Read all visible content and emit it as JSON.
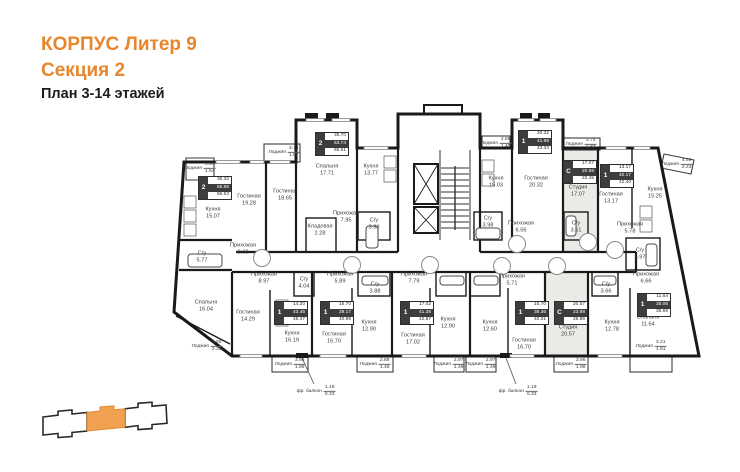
{
  "header": {
    "line1": "КОРПУС Литер 9",
    "line2": "Секция 2",
    "line3": "План 3-14 этажей"
  },
  "colors": {
    "accent": "#E8862B",
    "wall": "#1A1A1A",
    "stamp_dark": "#3D3D3D",
    "studio_fill": "#ECEAE6",
    "minimap_highlight": "#F2A150"
  },
  "plan": {
    "rooms": [
      {
        "name": "Кухня",
        "area": "15.07"
      },
      {
        "name": "Гостиная",
        "area": "19.28"
      },
      {
        "name": "Гостиная",
        "area": "18.65"
      },
      {
        "name": "Спальня",
        "area": "17.71"
      },
      {
        "name": "Кухня",
        "area": "13.77"
      },
      {
        "name": "Прихожая",
        "area": "7.95"
      },
      {
        "name": "Кладовая",
        "area": "2.28"
      },
      {
        "name": "С/у",
        "area": "3.98"
      },
      {
        "name": "Прихожая",
        "area": "8.60"
      },
      {
        "name": "С/у",
        "area": "5.77"
      },
      {
        "name": "Спальня",
        "area": "16.04"
      },
      {
        "name": "Гостиная",
        "area": "14.29"
      },
      {
        "name": "Прихожая",
        "area": "8.97"
      },
      {
        "name": "Кухня",
        "area": "16.19"
      },
      {
        "name": "С/у",
        "area": "4.04"
      },
      {
        "name": "Прихожая",
        "area": "5.89"
      },
      {
        "name": "С/у",
        "area": "3.88"
      },
      {
        "name": "Гостиная",
        "area": "16.70"
      },
      {
        "name": "Кухня",
        "area": "12.90"
      },
      {
        "name": "Прихожая",
        "area": "7.79"
      },
      {
        "name": "Гостиная",
        "area": "17.02"
      },
      {
        "name": "Кухня",
        "area": "12.90"
      },
      {
        "name": "Прихожая",
        "area": "5.71"
      },
      {
        "name": "Кухня",
        "area": "12.60"
      },
      {
        "name": "Гостиная",
        "area": "16.70"
      },
      {
        "name": "Студия",
        "area": "20.57"
      },
      {
        "name": "Кухня",
        "area": "15.03"
      },
      {
        "name": "Гостиная",
        "area": "20.32"
      },
      {
        "name": "Прихожая",
        "area": "6.56"
      },
      {
        "name": "С/у",
        "area": "3.98"
      },
      {
        "name": "Студия",
        "area": "17.07"
      },
      {
        "name": "С/у",
        "area": "3.51"
      },
      {
        "name": "Гостиная",
        "area": "13.17"
      },
      {
        "name": "Кухня",
        "area": "15.25"
      },
      {
        "name": "Прихожая",
        "area": "5.78"
      },
      {
        "name": "С/у",
        "area": "5.97"
      },
      {
        "name": "Прихожая",
        "area": "6.66"
      },
      {
        "name": "С/у",
        "area": "3.66"
      },
      {
        "name": "Кухня",
        "area": "12.78"
      },
      {
        "name": "Спальня",
        "area": "11.64"
      }
    ],
    "loggias": [
      {
        "name": "Лоджия",
        "upper": "3.97",
        "lower": "1.54"
      },
      {
        "name": "Лоджия",
        "upper": "3.74",
        "lower": "1.87"
      },
      {
        "name": "Лоджия",
        "upper": "2.88",
        "lower": "1.45"
      },
      {
        "name": "Лоджия",
        "upper": "3.74",
        "lower": "1.87"
      },
      {
        "name": "Лоджия",
        "upper": "4.45",
        "lower": "2.23"
      },
      {
        "name": "Лоджия",
        "upper": "4.65",
        "lower": "2.33"
      },
      {
        "name": "Лоджия",
        "upper": "3.96",
        "lower": "1.98"
      },
      {
        "name": "Лоджия",
        "upper": "2.89",
        "lower": "1.45"
      },
      {
        "name": "Лоджия",
        "upper": "2.97",
        "lower": "1.49"
      },
      {
        "name": "Лоджия",
        "upper": "2.97",
        "lower": "1.49"
      },
      {
        "name": "Лоджия",
        "upper": "3.96",
        "lower": "1.98"
      },
      {
        "name": "Лоджия",
        "upper": "3.21",
        "lower": "1.61"
      }
    ],
    "stamps": [
      {
        "type": "2",
        "living": "35.32",
        "total": "65.68",
        "total_with": "66.53"
      },
      {
        "type": "2",
        "living": "35.70",
        "total": "63.74",
        "total_with": "65.61"
      },
      {
        "type": "1",
        "living": "20.32",
        "total": "41.89",
        "total_with": "43.34"
      },
      {
        "type": "С",
        "living": "17.07",
        "total": "20.56",
        "total_with": "22.45"
      },
      {
        "type": "1",
        "living": "13.17",
        "total": "40.17",
        "total_with": "42.40"
      },
      {
        "type": "1",
        "living": "14.20",
        "total": "43.45",
        "total_with": "45.47"
      },
      {
        "type": "1",
        "living": "16.70",
        "total": "39.17",
        "total_with": "40.98"
      },
      {
        "type": "1",
        "living": "17.02",
        "total": "41.38",
        "total_with": "42.87"
      },
      {
        "type": "1",
        "living": "16.70",
        "total": "38.36",
        "total_with": "40.31"
      },
      {
        "type": "С",
        "living": "20.57",
        "total": "23.88",
        "total_with": "25.86"
      },
      {
        "type": "1",
        "living": "11.64",
        "total": "35.06",
        "total_with": "36.69"
      }
    ],
    "notes": [
      {
        "label": "фр. балкон",
        "upper": "1.19",
        "lower": "0.33"
      },
      {
        "label": "фр. балкон",
        "upper": "1.19",
        "lower": "0.33"
      }
    ]
  },
  "minimap": {
    "sections": 3,
    "highlighted_section": 2
  }
}
